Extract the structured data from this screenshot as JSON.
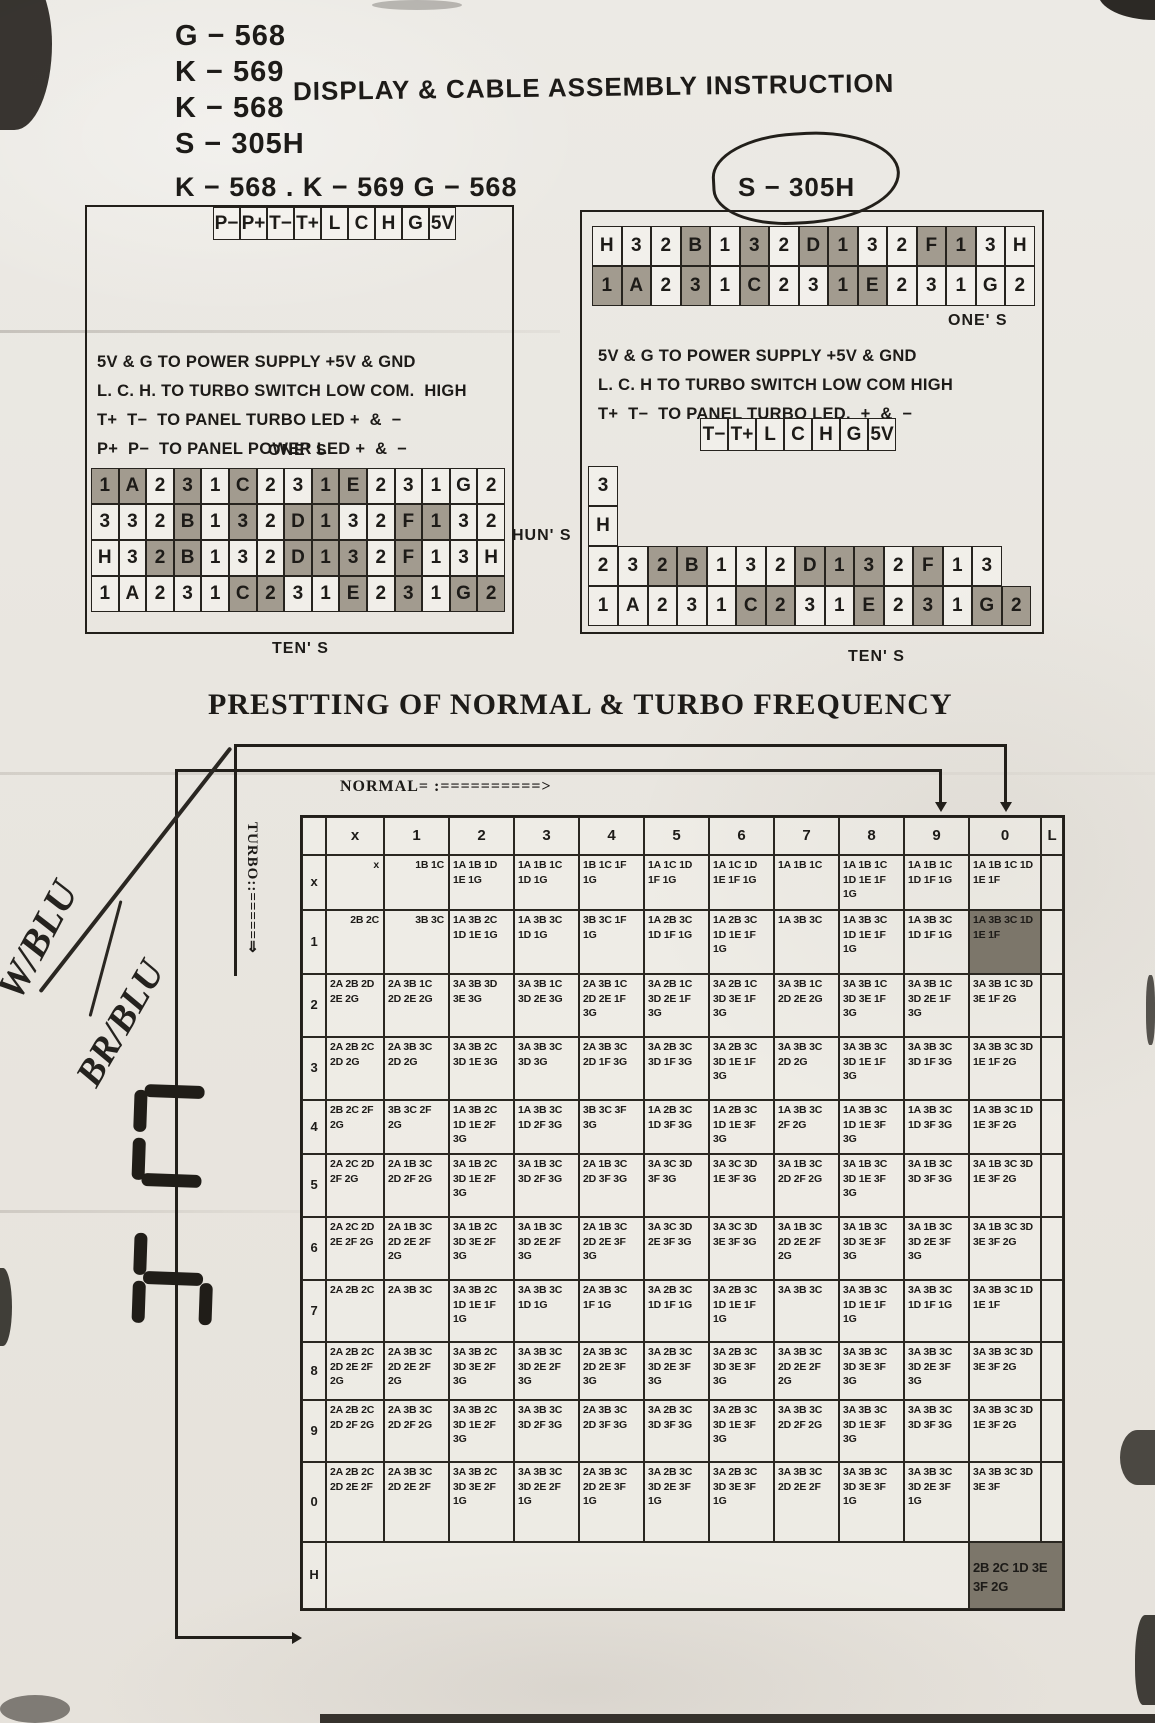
{
  "page": {
    "paper": "#e9e6e0",
    "ink": "#1d1b18",
    "shade": "#b2ab9f",
    "highlight": "#928b7e"
  },
  "header": {
    "models": [
      "G − 568",
      "K − 569",
      "K − 568",
      "S − 305H"
    ],
    "title": "DISPLAY & CABLE ASSEMBLY INSTRUCTION"
  },
  "left_panel": {
    "title": "K − 568 . K − 569 G − 568",
    "pins": [
      "P−",
      "P+",
      "T−",
      "T+",
      "L",
      "C",
      "H",
      "G",
      "5V"
    ],
    "notes": "5V & G TO POWER SUPPLY +5V & GND\nL. C. H. TO TURBO SWITCH LOW COM.  HIGH\nT+  T−  TO PANEL TURBO LED +  &  −\nP+  P−  TO PANEL POWER LED +  &  −",
    "ones_label": "ONE' S",
    "tens_label": "TEN' S",
    "huns_label": "HUN' S",
    "grid": [
      [
        {
          "t": "1",
          "s": 1
        },
        {
          "t": "A",
          "s": 1
        },
        {
          "t": "2"
        },
        {
          "t": "3",
          "s": 1
        },
        {
          "t": "1"
        },
        {
          "t": "C",
          "s": 1
        },
        {
          "t": "2"
        },
        {
          "t": "3"
        },
        {
          "t": "1",
          "s": 1
        },
        {
          "t": "E",
          "s": 1
        },
        {
          "t": "2"
        },
        {
          "t": "3"
        },
        {
          "t": "1"
        },
        {
          "t": "G"
        },
        {
          "t": "2"
        }
      ],
      [
        {
          "t": "3"
        },
        {
          "t": "3"
        },
        {
          "t": "2"
        },
        {
          "t": "B",
          "s": 1
        },
        {
          "t": "1"
        },
        {
          "t": "3",
          "s": 1
        },
        {
          "t": "2"
        },
        {
          "t": "D",
          "s": 1
        },
        {
          "t": "1",
          "s": 1
        },
        {
          "t": "3"
        },
        {
          "t": "2"
        },
        {
          "t": "F",
          "s": 1
        },
        {
          "t": "1",
          "s": 1
        },
        {
          "t": "3"
        },
        {
          "t": "2"
        }
      ],
      [
        {
          "t": "H"
        },
        {
          "t": "3"
        },
        {
          "t": "2",
          "s": 1
        },
        {
          "t": "B",
          "s": 1
        },
        {
          "t": "1"
        },
        {
          "t": "3"
        },
        {
          "t": "2"
        },
        {
          "t": "D",
          "s": 1
        },
        {
          "t": "1",
          "s": 1
        },
        {
          "t": "3",
          "s": 1
        },
        {
          "t": "2"
        },
        {
          "t": "F",
          "s": 1
        },
        {
          "t": "1"
        },
        {
          "t": "3"
        },
        {
          "t": "H"
        }
      ],
      [
        {
          "t": "1"
        },
        {
          "t": "A"
        },
        {
          "t": "2"
        },
        {
          "t": "3"
        },
        {
          "t": "1"
        },
        {
          "t": "C",
          "s": 1
        },
        {
          "t": "2",
          "s": 1
        },
        {
          "t": "3"
        },
        {
          "t": "1"
        },
        {
          "t": "E",
          "s": 1
        },
        {
          "t": "2"
        },
        {
          "t": "3",
          "s": 1
        },
        {
          "t": "1"
        },
        {
          "t": "G",
          "s": 1
        },
        {
          "t": "2",
          "s": 1
        }
      ]
    ]
  },
  "right_panel": {
    "title": "S − 305H",
    "row_a": [
      {
        "t": "H"
      },
      {
        "t": "3"
      },
      {
        "t": "2"
      },
      {
        "t": "B",
        "s": 1
      },
      {
        "t": "1"
      },
      {
        "t": "3",
        "s": 1
      },
      {
        "t": "2"
      },
      {
        "t": "D",
        "s": 1
      },
      {
        "t": "1",
        "s": 1
      },
      {
        "t": "3"
      },
      {
        "t": "2"
      },
      {
        "t": "F",
        "s": 1
      },
      {
        "t": "1",
        "s": 1
      },
      {
        "t": "3"
      },
      {
        "t": "H"
      }
    ],
    "row_b": [
      {
        "t": "1",
        "s": 1
      },
      {
        "t": "A",
        "s": 1
      },
      {
        "t": "2"
      },
      {
        "t": "3",
        "s": 1
      },
      {
        "t": "1"
      },
      {
        "t": "C",
        "s": 1
      },
      {
        "t": "2"
      },
      {
        "t": "3"
      },
      {
        "t": "1",
        "s": 1
      },
      {
        "t": "E",
        "s": 1
      },
      {
        "t": "2"
      },
      {
        "t": "3"
      },
      {
        "t": "1"
      },
      {
        "t": "G"
      },
      {
        "t": "2"
      }
    ],
    "ones_label": "ONE' S",
    "notes": "5V & G TO POWER SUPPLY +5V & GND\nL. C. H TO TURBO SWITCH LOW COM HIGH\nT+  T−  TO PANEL TURBO LED.  +  &  −",
    "pins": [
      "T−",
      "T+",
      "L",
      "C",
      "H",
      "G",
      "5V"
    ],
    "stack": [
      "3",
      "H"
    ],
    "row_c": [
      {
        "t": "2"
      },
      {
        "t": "3"
      },
      {
        "t": "2",
        "s": 1
      },
      {
        "t": "B",
        "s": 1
      },
      {
        "t": "1"
      },
      {
        "t": "3"
      },
      {
        "t": "2"
      },
      {
        "t": "D",
        "s": 1
      },
      {
        "t": "1",
        "s": 1
      },
      {
        "t": "3",
        "s": 1
      },
      {
        "t": "2"
      },
      {
        "t": "F",
        "s": 1
      },
      {
        "t": "1"
      },
      {
        "t": "3"
      }
    ],
    "row_d": [
      {
        "t": "1"
      },
      {
        "t": "A"
      },
      {
        "t": "2"
      },
      {
        "t": "3"
      },
      {
        "t": "1"
      },
      {
        "t": "C",
        "s": 1
      },
      {
        "t": "2",
        "s": 1
      },
      {
        "t": "3"
      },
      {
        "t": "1"
      },
      {
        "t": "E",
        "s": 1
      },
      {
        "t": "2"
      },
      {
        "t": "3",
        "s": 1
      },
      {
        "t": "1"
      },
      {
        "t": "G",
        "s": 1
      },
      {
        "t": "2",
        "s": 1
      }
    ],
    "tens_label": "TEN' S"
  },
  "freq_section": {
    "title": "PRESTTING OF NORMAL & TURBO FREQUENCY",
    "normal_label": "NORMAL= :==========>",
    "turbo_label": "TURBO::=====⇒",
    "handwriting": [
      "W/BLU",
      "BR/BLU"
    ],
    "segment_sketches": [
      {
        "on": [
          "A",
          "F",
          "E",
          "D"
        ]
      },
      {
        "on": [
          "F",
          "E",
          "G",
          "C"
        ]
      }
    ]
  },
  "freq_table": {
    "type": "table",
    "columns": [
      "",
      "x",
      "1",
      "2",
      "3",
      "4",
      "5",
      "6",
      "7",
      "8",
      "9",
      "0",
      "L"
    ],
    "rows": [
      {
        "label": "x",
        "cells": [
          "x",
          "1B 1C",
          "1A 1B 1D 1E 1G",
          "1A 1B 1C 1D 1G",
          "1B 1C 1F 1G",
          "1A 1C 1D 1F 1G",
          "1A 1C 1D 1E 1F 1G",
          "1A 1B 1C",
          "1A 1B 1C 1D 1E 1F 1G",
          "1A 1B 1C 1D 1F 1G",
          "1A 1B 1C 1D 1E 1F"
        ]
      },
      {
        "label": "1",
        "cells": [
          "2B 2C",
          "3B 3C",
          "1A 3B 2C 1D 1E 1G",
          "1A 3B 3C 1D 1G",
          "3B 3C 1F 1G",
          "1A 2B 3C 1D 1F 1G",
          "1A 2B 3C 1D 1E 1F 1G",
          "1A 3B 3C",
          "1A 3B 3C 1D 1E 1F 1G",
          "1A 3B 3C 1D 1F 1G",
          "1A 3B 3C 1D 1E 1F"
        ]
      },
      {
        "label": "2",
        "cells": [
          "2A 2B 2D 2E 2G",
          "2A 3B 1C 2D 2E 2G",
          "3A 3B 3D 3E 3G",
          "3A 3B 1C 3D 2E 3G",
          "2A 3B 1C 2D 2E 1F 3G",
          "3A 2B 1C 3D 2E 1F 3G",
          "3A 2B 1C 3D 3E 1F 3G",
          "3A 3B 1C 2D 2E 2G",
          "3A 3B 1C 3D 3E 1F 3G",
          "3A 3B 1C 3D 2E 1F 3G",
          "3A 3B 1C 3D 3E 1F 2G"
        ]
      },
      {
        "label": "3",
        "cells": [
          "2A 2B 2C 2D 2G",
          "2A 3B 3C 2D 2G",
          "3A 3B 2C 3D 1E 3G",
          "3A 3B 3C 3D 3G",
          "2A 3B 3C 2D 1F 3G",
          "3A 2B 3C 3D 1F 3G",
          "3A 2B 3C 3D 1E 1F 3G",
          "3A 3B 3C 2D 2G",
          "3A 3B 3C 3D 1E 1F 3G",
          "3A 3B 3C 3D 1F 3G",
          "3A 3B 3C 3D 1E 1F 2G"
        ]
      },
      {
        "label": "4",
        "cells": [
          "2B 2C 2F 2G",
          "3B 3C 2F 2G",
          "1A 3B 2C 1D 1E 2F 3G",
          "1A 3B 3C 1D 2F 3G",
          "3B 3C 3F 3G",
          "1A 2B 3C 1D 3F 3G",
          "1A 2B 3C 1D 1E 3F 3G",
          "1A 3B 3C 2F 2G",
          "1A 3B 3C 1D 1E 3F 3G",
          "1A 3B 3C 1D 3F 3G",
          "1A 3B 3C 1D 1E 3F 2G"
        ]
      },
      {
        "label": "5",
        "cells": [
          "2A 2C 2D 2F 2G",
          "2A 1B 3C 2D 2F 2G",
          "3A 1B 2C 3D 1E 2F 3G",
          "3A 1B 3C 3D 2F 3G",
          "2A 1B 3C 2D 3F 3G",
          "3A 3C 3D 3F 3G",
          "3A 3C 3D 1E 3F 3G",
          "3A 1B 3C 2D 2F 2G",
          "3A 1B 3C 3D 1E 3F 3G",
          "3A 1B 3C 3D 3F 3G",
          "3A 1B 3C 3D 1E 3F 2G"
        ]
      },
      {
        "label": "6",
        "cells": [
          "2A 2C 2D 2E 2F 2G",
          "2A 1B 3C 2D 2E 2F 2G",
          "3A 1B 2C 3D 3E 2F 3G",
          "3A 1B 3C 3D 2E 2F 3G",
          "2A 1B 3C 2D 2E 3F 3G",
          "3A 3C 3D 2E 3F 3G",
          "3A 3C 3D 3E 3F 3G",
          "3A 1B 3C 2D 2E 2F 2G",
          "3A 1B 3C 3D 3E 3F 3G",
          "3A 1B 3C 3D 2E 3F 3G",
          "3A 1B 3C 3D 3E 3F 2G"
        ]
      },
      {
        "label": "7",
        "cells": [
          "2A 2B 2C",
          "2A 3B 3C",
          "3A 3B 2C 1D 1E 1F 1G",
          "3A 3B 3C 1D 1G",
          "2A 3B 3C 1F 1G",
          "3A 2B 3C 1D 1F 1G",
          "3A 2B 3C 1D 1E 1F 1G",
          "3A 3B 3C",
          "3A 3B 3C 1D 1E 1F 1G",
          "3A 3B 3C 1D 1F 1G",
          "3A 3B 3C 1D 1E 1F"
        ]
      },
      {
        "label": "8",
        "cells": [
          "2A 2B 2C 2D 2E 2F 2G",
          "2A 3B 3C 2D 2E 2F 2G",
          "3A 3B 2C 3D 3E 2F 3G",
          "3A 3B 3C 3D 2E 2F 3G",
          "2A 3B 3C 2D 2E 3F 3G",
          "3A 2B 3C 3D 2E 3F 3G",
          "3A 2B 3C 3D 3E 3F 3G",
          "3A 3B 3C 2D 2E 2F 2G",
          "3A 3B 3C 3D 3E 3F 3G",
          "3A 3B 3C 3D 2E 3F 3G",
          "3A 3B 3C 3D 3E 3F 2G"
        ]
      },
      {
        "label": "9",
        "cells": [
          "2A 2B 2C 2D 2F 2G",
          "2A 3B 3C 2D 2F 2G",
          "3A 3B 2C 3D 1E 2F 3G",
          "3A 3B 3C 3D 2F 3G",
          "2A 3B 3C 2D 3F 3G",
          "3A 2B 3C 3D 3F 3G",
          "3A 2B 3C 3D 1E 3F 3G",
          "3A 3B 3C 2D 2F 2G",
          "3A 3B 3C 3D 1E 3F 3G",
          "3A 3B 3C 3D 3F 3G",
          "3A 3B 3C 3D 1E 3F 2G"
        ]
      },
      {
        "label": "0",
        "cells": [
          "2A 2B 2C 2D 2E 2F",
          "2A 3B 3C 2D 2E 2F",
          "3A 3B 2C 3D 3E 2F 1G",
          "3A 3B 3C 3D 2E 2F 1G",
          "2A 3B 3C 2D 2E 3F 1G",
          "3A 2B 3C 3D 2E 3F 1G",
          "3A 2B 3C 3D 3E 3F 1G",
          "3A 3B 3C 2D 2E 2F",
          "3A 3B 3C 3D 3E 3F 1G",
          "3A 3B 3C 3D 2E 3F 1G",
          "3A 3B 3C 3D 3E 3F"
        ]
      },
      {
        "label": "H",
        "cells": []
      }
    ],
    "highlight": {
      "row_label": "1",
      "col": "0"
    },
    "corner_cell": "2B 2C 1D 3E 3F 2G"
  }
}
